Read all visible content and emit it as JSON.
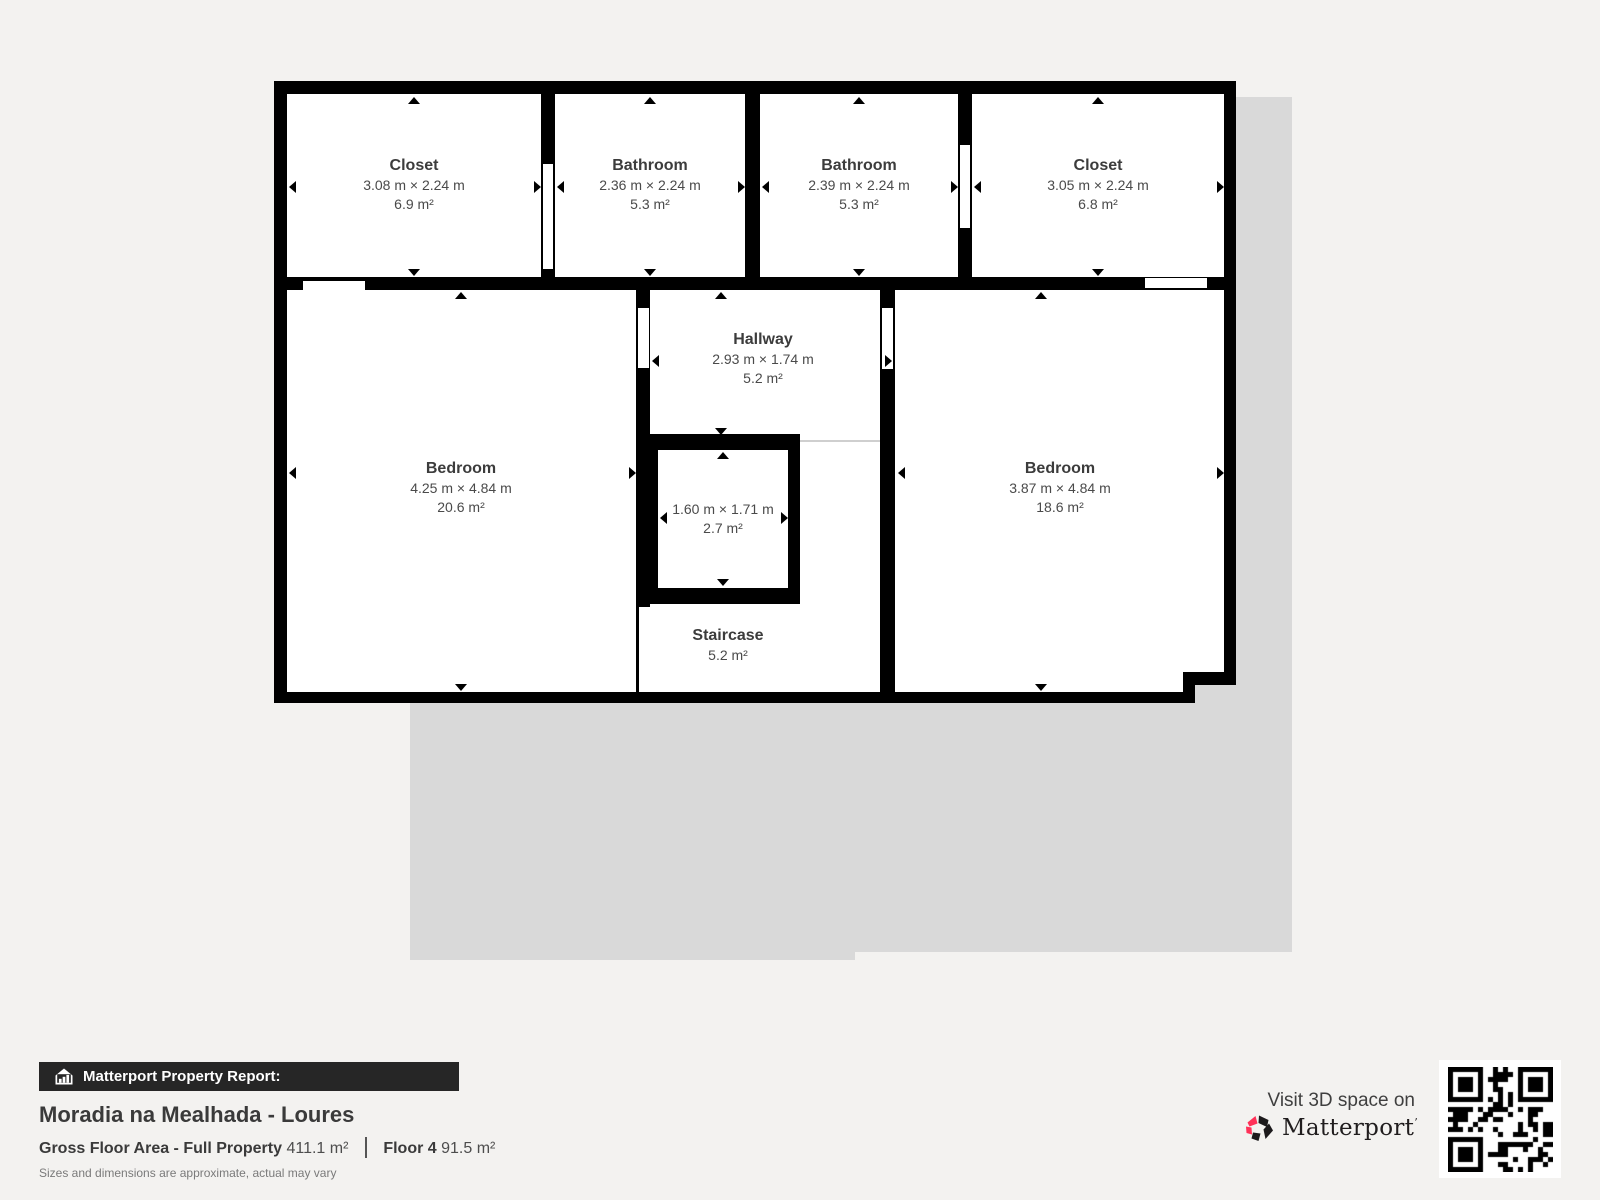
{
  "floor_plan": {
    "rooms": [
      {
        "name": "Closet",
        "dims": "3.08 m × 2.24 m",
        "area": "6.9 m²"
      },
      {
        "name": "Bathroom",
        "dims": "2.36 m × 2.24 m",
        "area": "5.3 m²"
      },
      {
        "name": "Bathroom",
        "dims": "2.39 m × 2.24 m",
        "area": "5.3 m²"
      },
      {
        "name": "Closet",
        "dims": "3.05 m × 2.24 m",
        "area": "6.8 m²"
      },
      {
        "name": "Bedroom",
        "dims": "4.25 m × 4.84 m",
        "area": "20.6 m²"
      },
      {
        "name": "Hallway",
        "dims": "2.93 m × 1.74 m",
        "area": "5.2 m²"
      },
      {
        "name": "",
        "dims": "1.60 m × 1.71 m",
        "area": "2.7 m²"
      },
      {
        "name": "Staircase",
        "dims": "",
        "area": "5.2 m²"
      },
      {
        "name": "Bedroom",
        "dims": "3.87 m × 4.84 m",
        "area": "18.6 m²"
      }
    ]
  },
  "report": {
    "bar_label": "Matterport Property Report:",
    "property_title": "Moradia na Mealhada - Loures",
    "gross_label": "Gross Floor Area - Full Property",
    "gross_value": "411.1 m²",
    "floor_label": "Floor 4",
    "floor_value": "91.5 m²",
    "disclaimer": "Sizes and dimensions are approximate, actual may vary"
  },
  "promo": {
    "visit_text": "Visit 3D space on",
    "brand": "Matterport",
    "trademark": "’"
  },
  "colors": {
    "accent_pink": "#ff3158",
    "wall": "#000000",
    "footprint_shadow": "#d9d9d9",
    "background": "#f3f2f0",
    "bar_background": "#262626"
  }
}
